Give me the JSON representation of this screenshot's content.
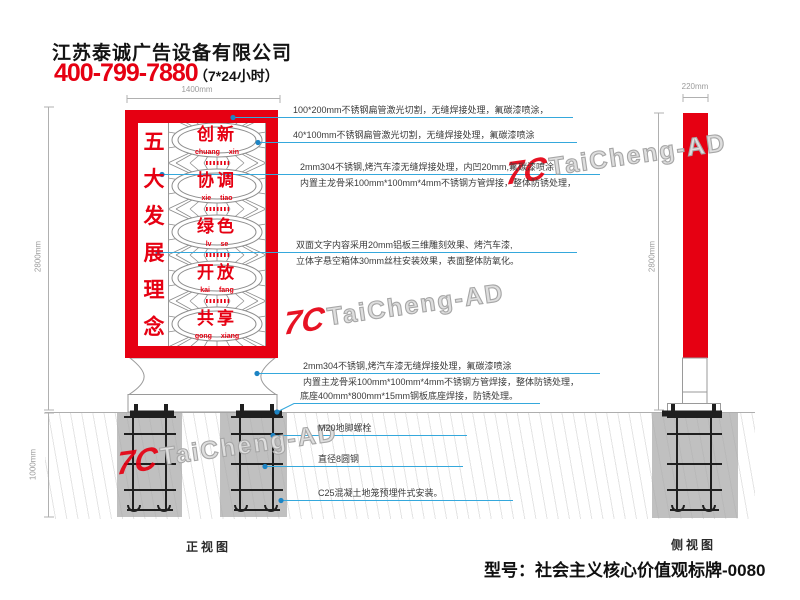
{
  "header": {
    "company": "江苏泰诚广告设备有限公司",
    "phone": "400-799-7880",
    "hours": "（7*24小时）"
  },
  "sign": {
    "slogan": [
      "五",
      "大",
      "发",
      "展",
      "理",
      "念"
    ],
    "values": [
      {
        "word": "创新",
        "pinyin": "chuang xin"
      },
      {
        "word": "协调",
        "pinyin": "xie tiao"
      },
      {
        "word": "绿色",
        "pinyin": "lv se"
      },
      {
        "word": "开放",
        "pinyin": "kai fang"
      },
      {
        "word": "共享",
        "pinyin": "gong xiang"
      }
    ]
  },
  "annotations": [
    {
      "line1": "100*200mm不锈钢扁管激光切割，无缝焊接处理，氟碳漆喷涂，",
      "line2": ""
    },
    {
      "line1": "40*100mm不锈钢扁管激光切割，无缝焊接处理，氟碳漆喷涂",
      "line2": ""
    },
    {
      "line1": "2mm304不锈钢,烤汽车漆无缝焊接处理，内凹20mm,氟碳漆喷涂",
      "line2": "内置主龙骨采100mm*100mm*4mm不锈钢方管焊接，整体防锈处理，"
    },
    {
      "line1": "双面文字内容采用20mm铝板三维雕刻效果、烤汽车漆,",
      "line2": "立体字悬空箱体30mm丝柱安装效果，表面整体防氧化。"
    },
    {
      "line1": "2mm304不锈钢,烤汽车漆无缝焊接处理，氟碳漆喷涂",
      "line2": "内置主龙骨采100mm*100mm*4mm不锈钢方管焊接，整体防锈处理，"
    },
    {
      "line1": "底座400mm*800mm*15mm钢板底座焊接，防锈处理。",
      "line2": ""
    },
    {
      "line1": "M20地脚螺栓",
      "line2": ""
    },
    {
      "line1": "直径8圆钢",
      "line2": ""
    },
    {
      "line1": "C25混凝土地笼预埋件式安装。",
      "line2": ""
    }
  ],
  "dimensions": {
    "sign_width": "1400mm",
    "front_height": "2800mm",
    "foundation_depth": "1000mm",
    "side_height": "2800mm",
    "side_width": "220mm"
  },
  "views": {
    "front_label": "正视图",
    "side_label": "侧视图"
  },
  "watermark": {
    "logo": "7C",
    "brand": "TaiCheng-AD"
  },
  "model_label": "型号：社会主义核心价值观标牌-0080",
  "colors": {
    "accent_red": "#e60012",
    "leader_blue": "#29abe2"
  }
}
